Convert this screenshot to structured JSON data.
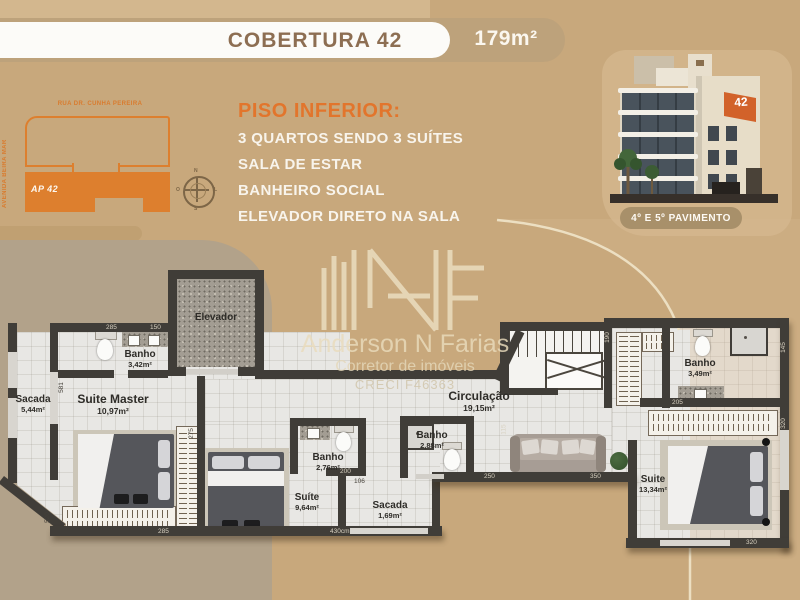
{
  "banner": {
    "title": "COBERTURA 42",
    "area": "179m²"
  },
  "site_map": {
    "street_top": "RUA DR. CUNHA PEREIRA",
    "street_left": "AVENIDA BEIRA MAR",
    "unit_label": "AP 42",
    "compass": {
      "n": "N",
      "s": "S",
      "e": "L",
      "w": "O"
    }
  },
  "description": {
    "heading": "PISO INFERIOR:",
    "items": [
      "3 QUARTOS SENDO 3 SUÍTES",
      "SALA DE ESTAR",
      "BANHEIRO SOCIAL",
      "ELEVADOR DIRETO NA SALA"
    ]
  },
  "building": {
    "unit_badge": "42",
    "caption": "4º E 5º PAVIMENTO"
  },
  "watermark": {
    "name": "Anderson N Farias",
    "role": "Corretor de imóveis",
    "license": "CRECI F46363"
  },
  "floor_plan": {
    "rooms": [
      {
        "name": "Elevador",
        "area": ""
      },
      {
        "name": "Banho",
        "area": "3,42m²"
      },
      {
        "name": "Suite Master",
        "area": "10,97m²"
      },
      {
        "name": "Sacada",
        "area": "5,44m²"
      },
      {
        "name": "Banho",
        "area": "2,76m²"
      },
      {
        "name": "Suíte",
        "area": "9,64m²"
      },
      {
        "name": "Sacada",
        "area": "1,69m²"
      },
      {
        "name": "Banho",
        "area": "2,88m²"
      },
      {
        "name": "Circulação",
        "area": "19,15m²"
      },
      {
        "name": "Banho",
        "area": "3,49m²"
      },
      {
        "name": "Suite",
        "area": "13,34m²"
      }
    ],
    "dimensions": [
      "285",
      "150",
      "581",
      "275",
      "520",
      "285",
      "430cm",
      "200",
      "106",
      "250",
      "350",
      "115",
      "190",
      "145",
      "205",
      "320",
      "320"
    ]
  },
  "colors": {
    "accent_orange": "#e2752c",
    "tan_background": "#c8a87c",
    "wall": "#403d38"
  }
}
